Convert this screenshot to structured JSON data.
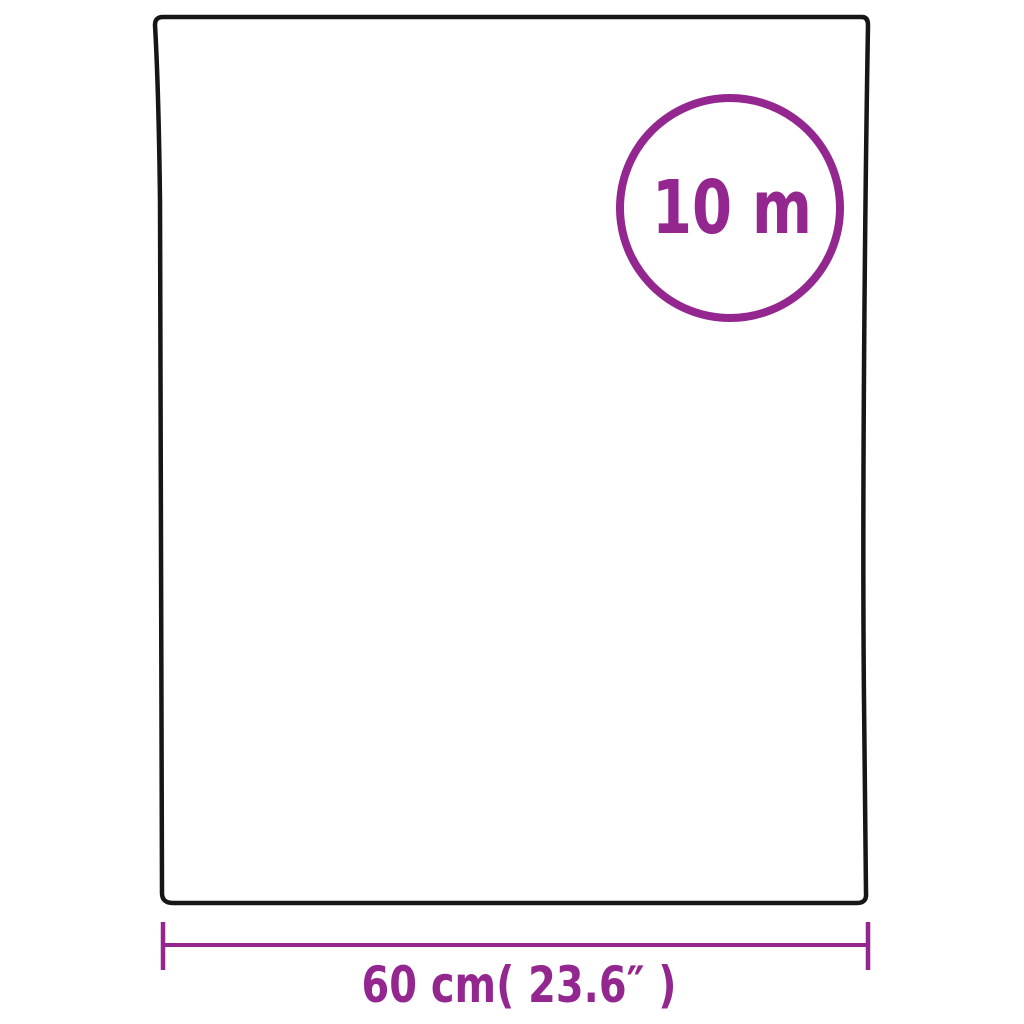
{
  "diagram": {
    "type": "product-dimension-diagram",
    "badge": {
      "length_label": "10 m"
    },
    "dimension": {
      "width_label": "60 cm( 23.6″  )"
    }
  },
  "colors": {
    "accent": "#93278F",
    "outline": "#161616",
    "background": "#FFFFFF"
  }
}
